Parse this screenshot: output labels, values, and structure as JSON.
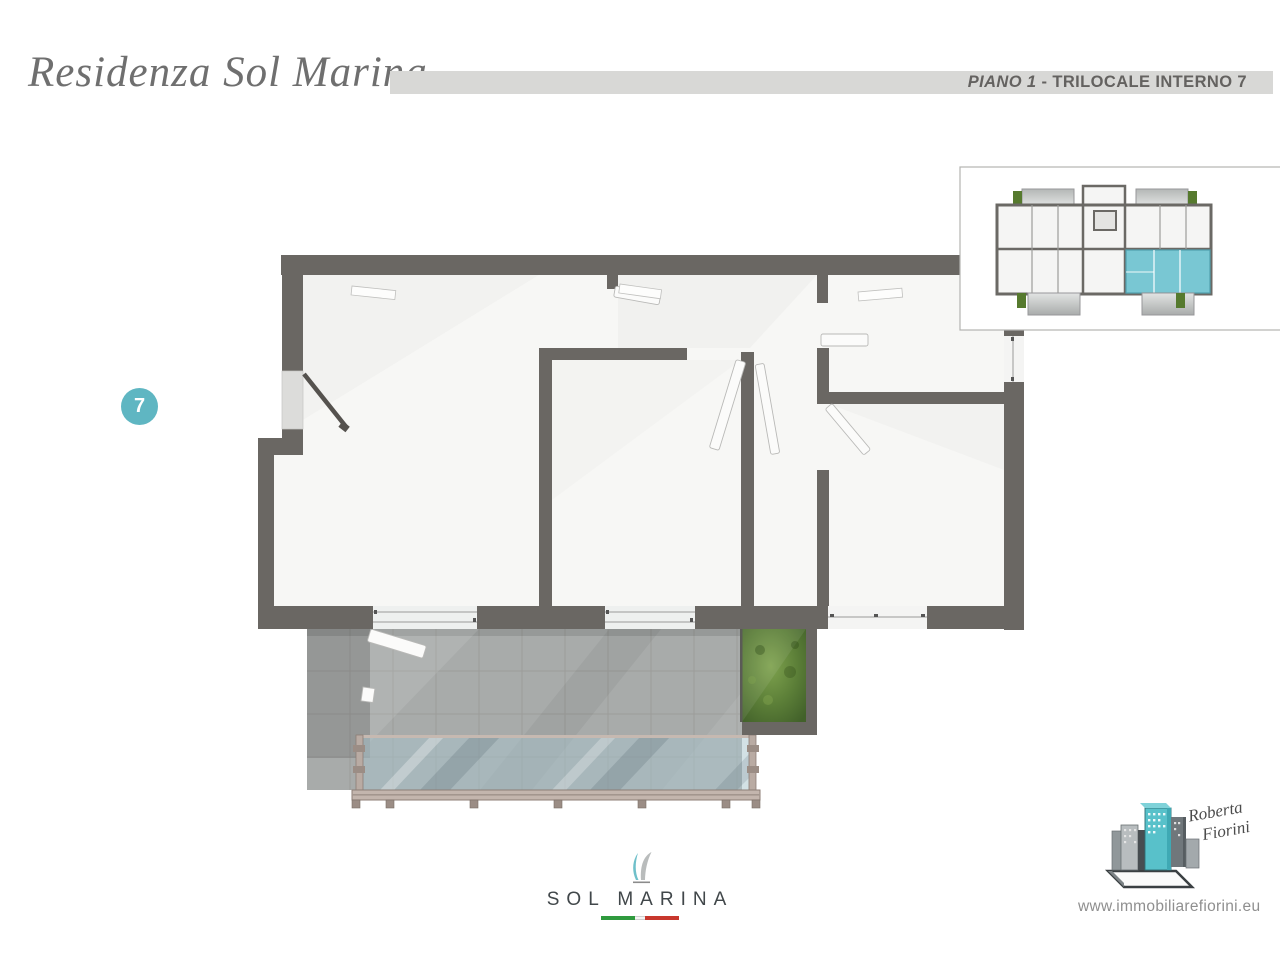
{
  "header": {
    "title": "Residenza Sol Marina",
    "floor_label": "PIANO 1",
    "separator": " - ",
    "unit_label": "TRILOCALE INTERNO 7",
    "band_color": "#d8d8d6",
    "text_color": "#646260"
  },
  "unit_badge": {
    "number": "7",
    "color": "#5fb6c2"
  },
  "floor_plan": {
    "wall_color": "#6a6763",
    "floor_color": "#f7f7f5",
    "terrace_tile_color": "#a8abaa",
    "glass_color": "#aac3cc",
    "railing_color": "#c3b5ad",
    "garden_color": "#55742f"
  },
  "minimap": {
    "highlight_color": "#79c7d3",
    "border_color": "#b3b3b1",
    "planter_color": "#567a2e"
  },
  "footer": {
    "logo_text": "SOL MARINA",
    "sail_teal": "#6fc0ca",
    "sail_gray": "#b9bcbc",
    "flag_colors": [
      "#2f9a3e",
      "#f4f4f4",
      "#c8372d"
    ],
    "agency_name_line1": "Roberta",
    "agency_name_line2": "Fiorini",
    "agency_teal": "#58c1ca",
    "website": "www.immobiliarefiorini.eu"
  }
}
